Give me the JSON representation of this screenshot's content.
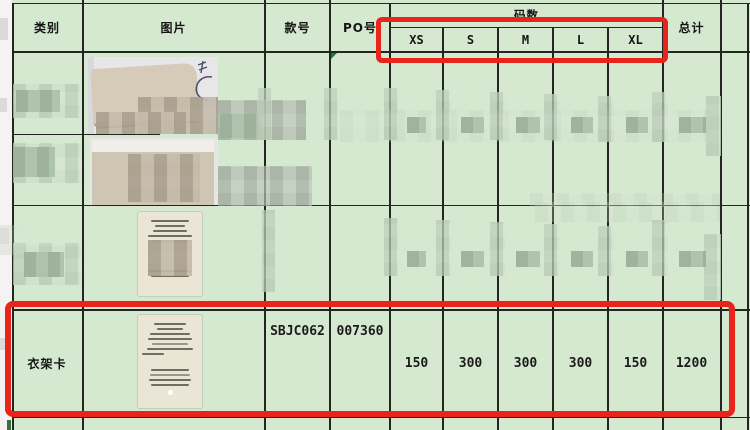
{
  "header": {
    "category": "类别",
    "picture": "图片",
    "style_no": "款号",
    "po_no": "PO号",
    "size_group": "码数",
    "sizes": [
      "XS",
      "S",
      "M",
      "L",
      "XL"
    ],
    "total": "总计"
  },
  "row": {
    "category": "衣架卡",
    "style_no": "SBJC062",
    "po_no": "007360",
    "qty": [
      "150",
      "300",
      "300",
      "300",
      "150"
    ],
    "total": "1200"
  },
  "colors": {
    "cell_background": "#d5e9d1",
    "grid_line": "#222520",
    "highlight_box_red": "#e8241b",
    "error_flag_green": "#1e7a2a"
  }
}
